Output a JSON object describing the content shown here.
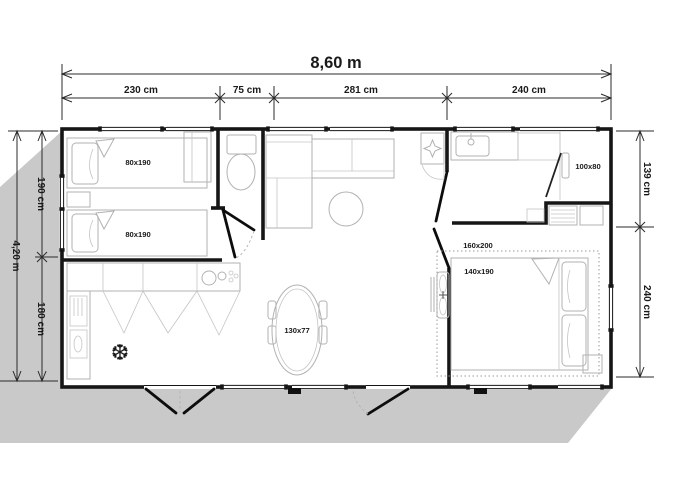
{
  "header": {
    "overall_width_label": "8,60 m"
  },
  "dimensions": {
    "top": [
      "230 cm",
      "75 cm",
      "281 cm",
      "240 cm"
    ],
    "left": {
      "overall": "4,20 m",
      "segments": [
        "190 cm",
        "180 cm"
      ]
    },
    "right": {
      "segments": [
        "139 cm",
        "240 cm"
      ]
    }
  },
  "furniture_labels": {
    "twin_bed_top": "80x190",
    "twin_bed_bottom": "80x190",
    "shower_tray": "100x80",
    "double_bed_footprint": "160x200",
    "double_bed_mattress": "140x190",
    "dining_table": "130x77"
  },
  "icons": {
    "freezer_snowflake": "❆"
  },
  "colors": {
    "wall": "#161616",
    "shadow": "#c9c9c9",
    "furniture_line": "#b2b2b2",
    "dimension_line": "#2b2b2b",
    "background": "#ffffff"
  }
}
